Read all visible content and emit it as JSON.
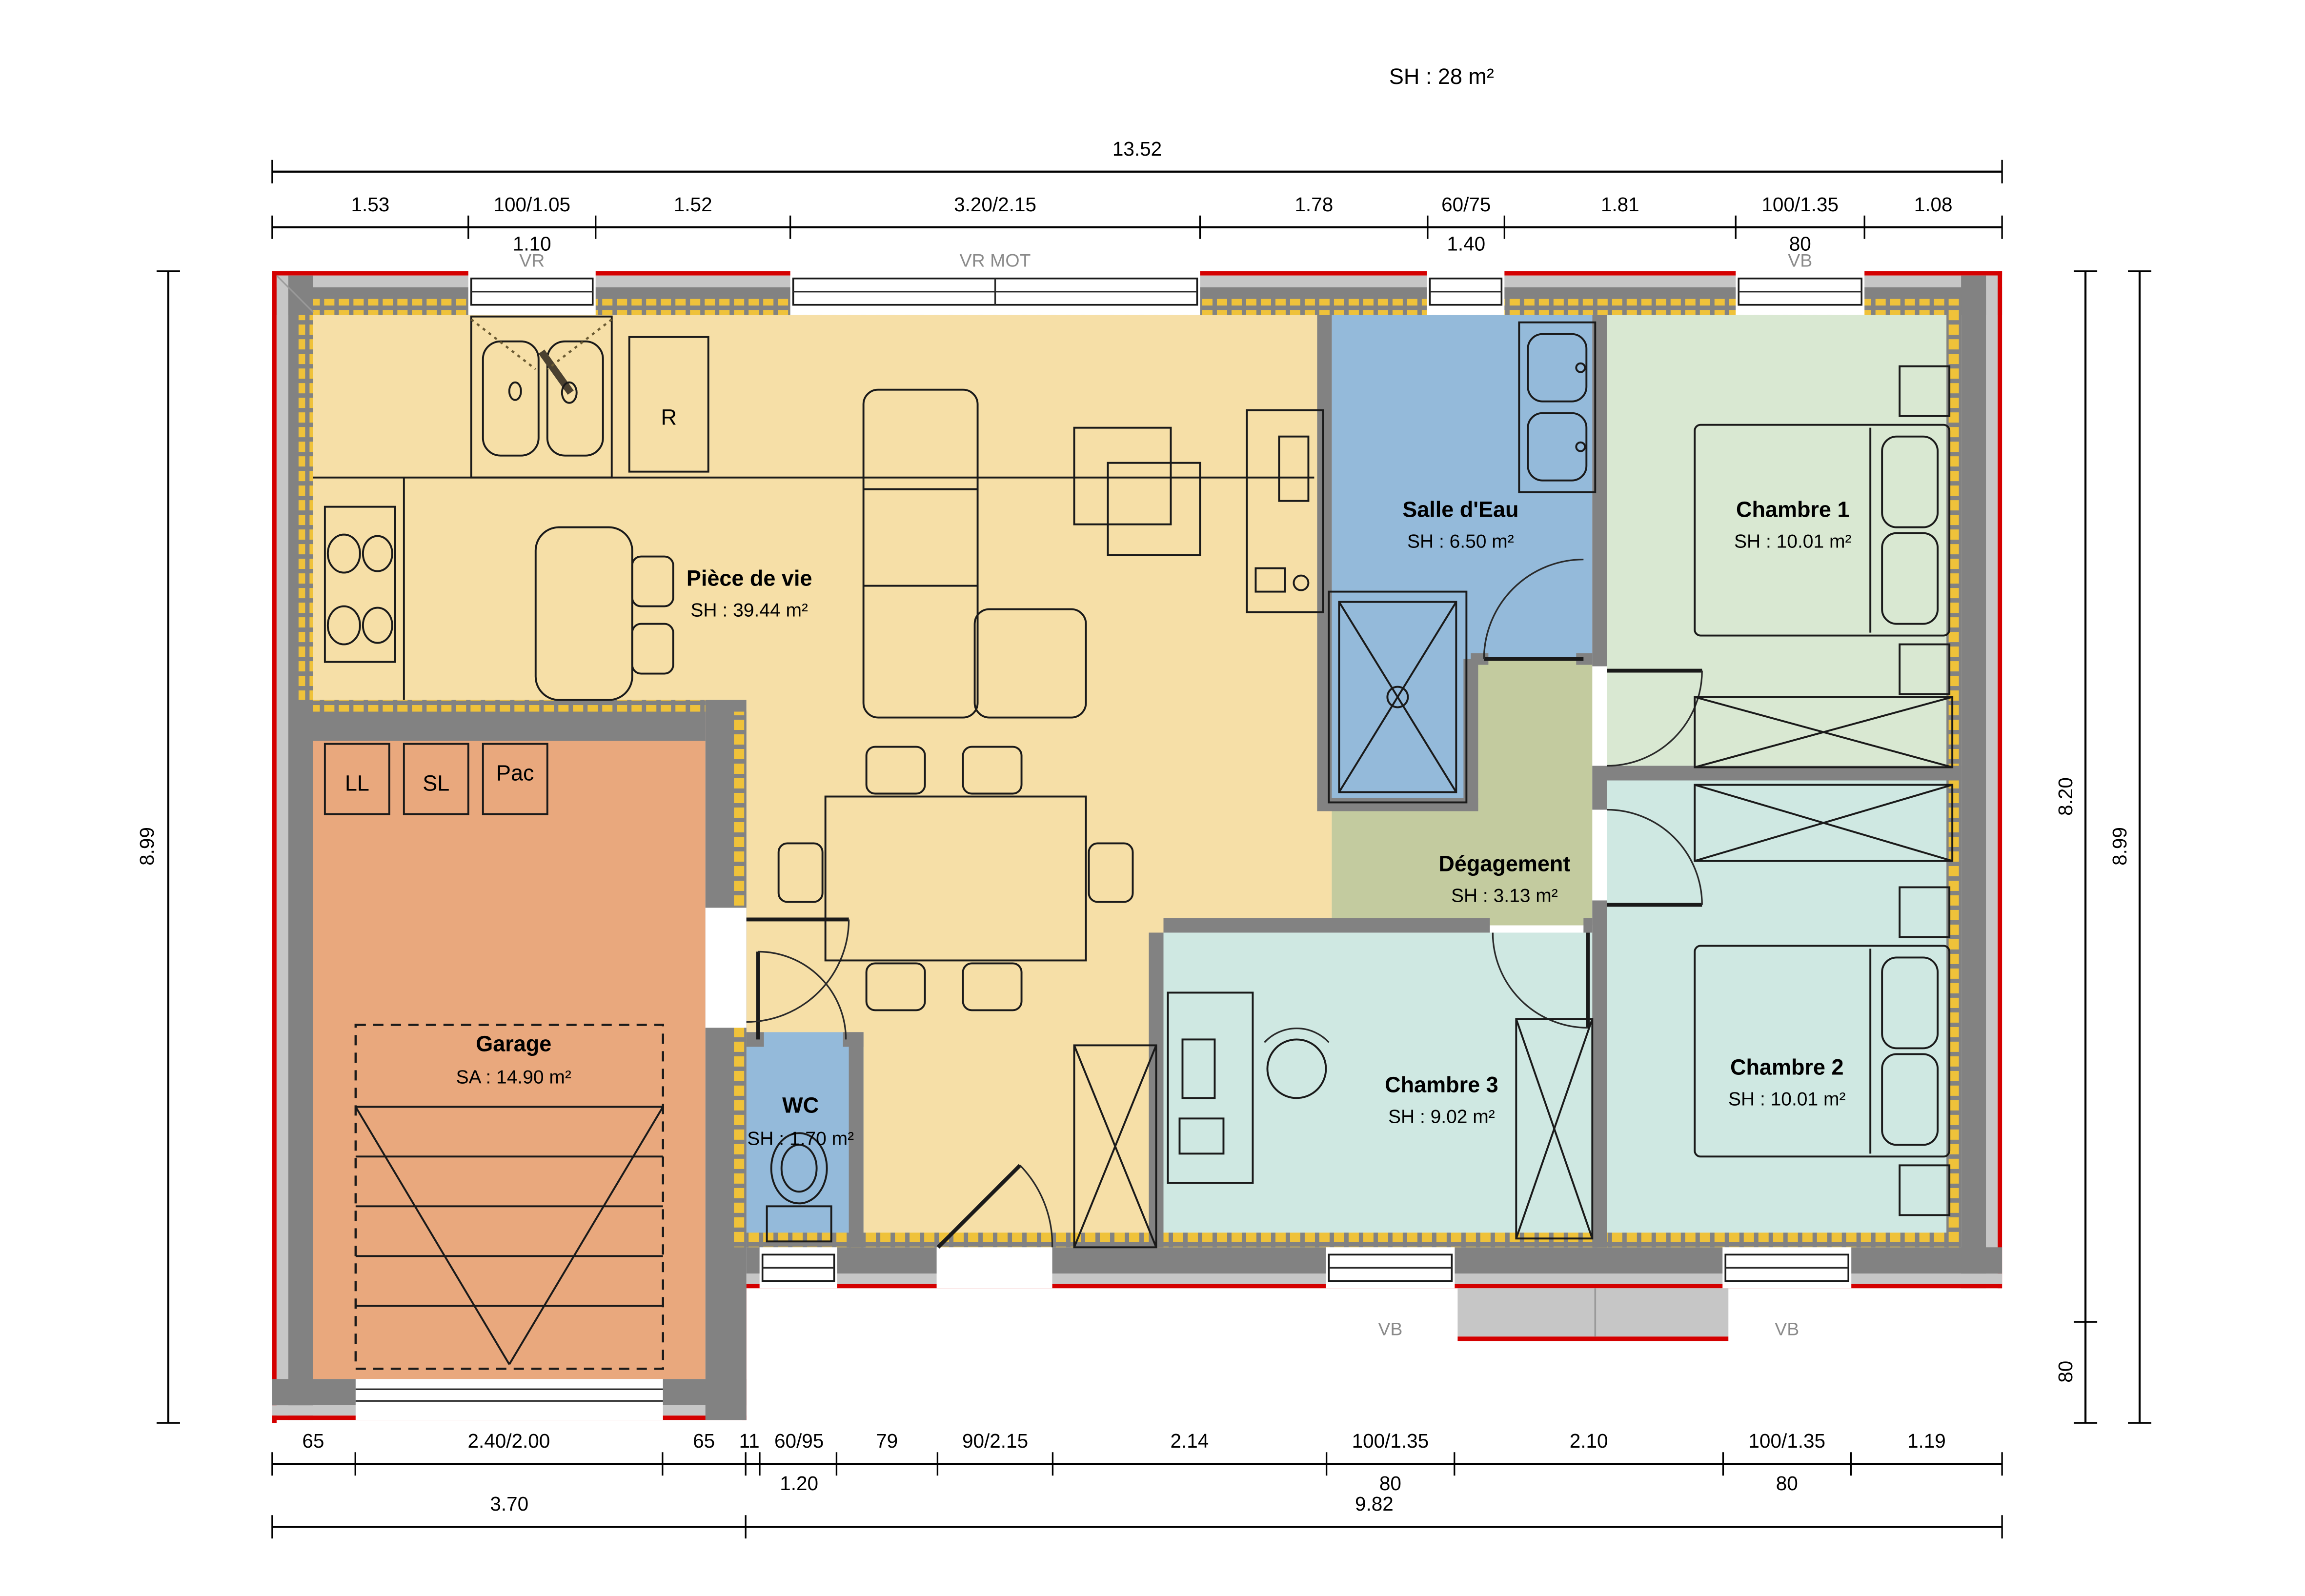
{
  "title": "SH : 28 m²",
  "rooms": {
    "piece_de_vie": {
      "name": "Pièce de vie",
      "area": "SH : 39.44 m²"
    },
    "salle_eau": {
      "name": "Salle d'Eau",
      "area": "SH : 6.50 m²"
    },
    "chambre1": {
      "name": "Chambre 1",
      "area": "SH : 10.01 m²"
    },
    "chambre2": {
      "name": "Chambre 2",
      "area": "SH : 10.01 m²"
    },
    "chambre3": {
      "name": "Chambre 3",
      "area": "SH : 9.02 m²"
    },
    "degagement": {
      "name": "Dégagement",
      "area": "SH : 3.13 m²"
    },
    "wc": {
      "name": "WC",
      "area": "SH : 1.70 m²"
    },
    "garage": {
      "name": "Garage",
      "area": "SA : 14.90 m²"
    }
  },
  "equipment": {
    "fridge": "R",
    "washing_machine": "LL",
    "dryer": "SL",
    "heat_pump": "Pac"
  },
  "dims": {
    "top": {
      "total": "13.52",
      "segments": [
        "1.53",
        "100/1.05",
        "1.52",
        "3.20/2.15",
        "1.78",
        "60/75",
        "1.81",
        "100/1.35",
        "1.08"
      ],
      "sills": [
        "1.10",
        "1.40",
        "80"
      ],
      "tags": [
        "VR",
        "VR MOT",
        "VB"
      ]
    },
    "bottom": {
      "segments": [
        "65",
        "2.40/2.00",
        "65",
        "11",
        "60/95",
        "79",
        "90/2.15",
        "2.14",
        "100/1.35",
        "2.10",
        "100/1.35",
        "1.19"
      ],
      "sills": [
        "1.20",
        "80",
        "80"
      ],
      "totals": [
        "3.70",
        "9.82"
      ],
      "tags": [
        "VB",
        "VB"
      ]
    },
    "left": {
      "total": "8.99"
    },
    "right": {
      "inner": "8.20",
      "inner_bottom": "80",
      "outer": "8.99"
    }
  },
  "colors": {
    "living": "#F6DFA7",
    "garage": "#E9A87D",
    "water_rooms": "#94BADA",
    "chambre1": "#D9E8D2",
    "chambre2_3": "#CFE8E2",
    "degagement": "#C3CB9F",
    "wall_gray": "#828282",
    "render_gray": "#C6C6C6",
    "insulation_yellow": "#EFC23A",
    "exterior_red": "#D40000"
  }
}
